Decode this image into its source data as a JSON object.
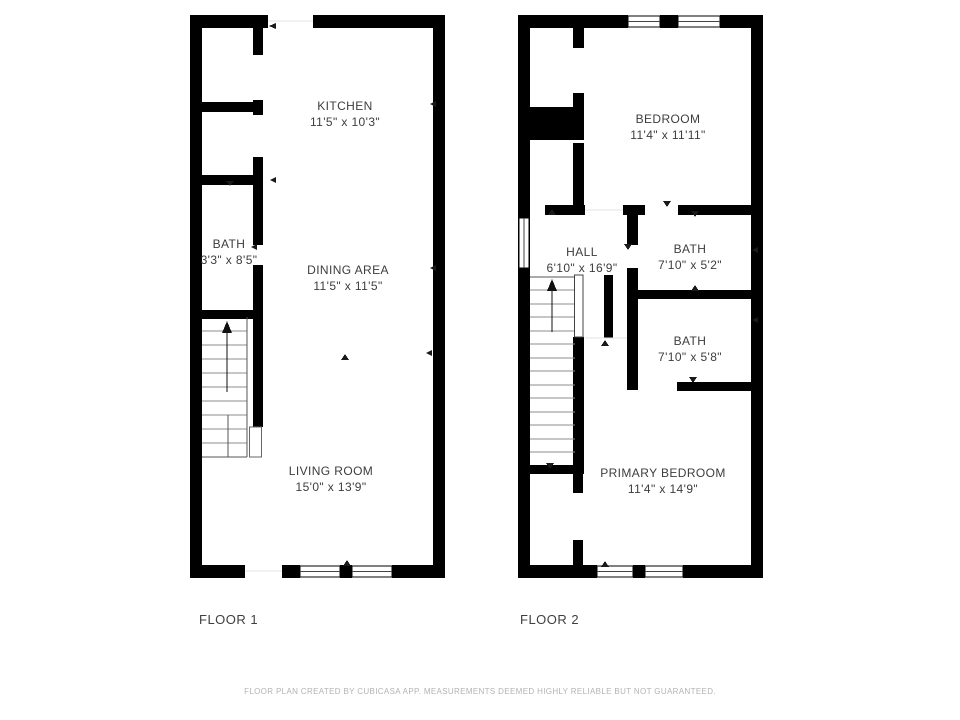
{
  "colors": {
    "wall": "#000000",
    "label_text": "#3d3d3d",
    "footer_text": "#b3b3b3",
    "background": "#ffffff"
  },
  "floors": [
    {
      "label": "FLOOR 1",
      "rooms": [
        {
          "name": "KITCHEN",
          "dims": "11'5\" x 10'3\""
        },
        {
          "name": "BATH",
          "dims": "3'3\" x 8'5\""
        },
        {
          "name": "DINING AREA",
          "dims": "11'5\" x 11'5\""
        },
        {
          "name": "LIVING ROOM",
          "dims": "15'0\" x 13'9\""
        }
      ]
    },
    {
      "label": "FLOOR 2",
      "rooms": [
        {
          "name": "BEDROOM",
          "dims": "11'4\" x 11'11\""
        },
        {
          "name": "HALL",
          "dims": "6'10\" x 16'9\""
        },
        {
          "name": "BATH",
          "dims": "7'10\" x 5'2\""
        },
        {
          "name": "BATH",
          "dims": "7'10\" x 5'8\""
        },
        {
          "name": "PRIMARY BEDROOM",
          "dims": "11'4\" x 14'9\""
        }
      ]
    }
  ],
  "footer": {
    "disclaimer": "FLOOR PLAN CREATED BY CUBICASA APP. MEASUREMENTS DEEMED HIGHLY RELIABLE BUT NOT GUARANTEED."
  }
}
